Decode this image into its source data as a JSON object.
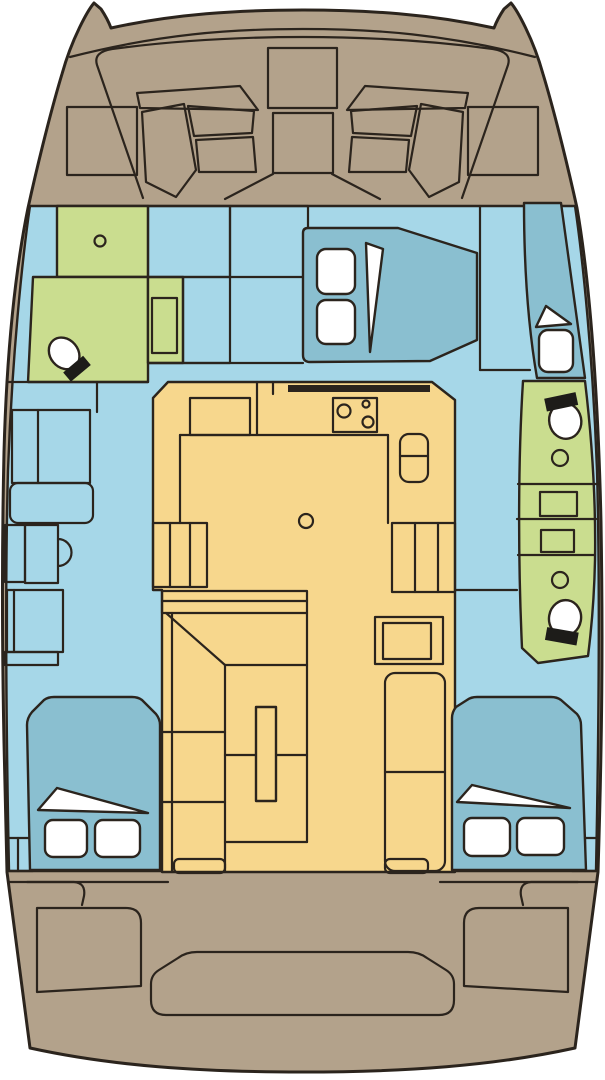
{
  "diagram": {
    "title": "Catamaran interior layout — top-view floor plan",
    "type": "boat-floor-plan",
    "orientation": {
      "top": "bow",
      "bottom": "stern"
    }
  },
  "colors": {
    "background": "#ffffff",
    "outline": "#2b241d",
    "deck": "#b3a28b",
    "floor": "#a6d7e8",
    "bed": "#8abfd0",
    "wet_area": "#cadd8f",
    "furniture": "#f7d78d",
    "fixture_white": "#ffffff",
    "fixture_black": "#1d1c19"
  },
  "legend": {
    "deck": "Exterior deck",
    "floor": "Interior floor",
    "bed": "Berths / beds",
    "wet_area": "Heads & showers",
    "furniture": "Salon & galley furniture"
  },
  "rooms": {
    "bow_deck": {
      "label": "Foredeck with trampoline panels"
    },
    "port_forward_head": {
      "label": "Port forward head",
      "fixtures": [
        "toilet",
        "washbasin",
        "shower tray"
      ]
    },
    "port_hull_passage": {
      "label": "Port hull passage",
      "fixtures": [
        "wardrobe",
        "seat",
        "vanity with basin",
        "storage"
      ]
    },
    "port_aft_cabin": {
      "label": "Port aft double cabin",
      "fixtures": [
        "double berth",
        "2 pillows",
        "entry steps"
      ]
    },
    "forward_cabin": {
      "label": "Forward double cabin",
      "fixtures": [
        "double berth",
        "2 pillows",
        "wardrobes"
      ]
    },
    "galley": {
      "label": "Galley",
      "fixtures": [
        "stove with burners",
        "twin sink",
        "worktop",
        "storage columns"
      ]
    },
    "salon": {
      "label": "Salon / dinette",
      "fixtures": [
        "C-shaped settee",
        "folding table",
        "chart seat",
        "sofa"
      ]
    },
    "starboard_forward_berth": {
      "label": "Starboard forward berth",
      "fixtures": [
        "single berth",
        "pillow"
      ]
    },
    "starboard_heads": {
      "label": "Starboard heads block",
      "fixtures": [
        "2 toilets",
        "2 washbasins",
        "2 shower trays"
      ]
    },
    "starboard_aft_cabin": {
      "label": "Starboard aft double cabin",
      "fixtures": [
        "double berth",
        "2 pillows",
        "entry steps"
      ]
    },
    "cockpit": {
      "label": "Aft cockpit",
      "fixtures": [
        "side benches",
        "transom seat",
        "entry steps"
      ]
    }
  }
}
